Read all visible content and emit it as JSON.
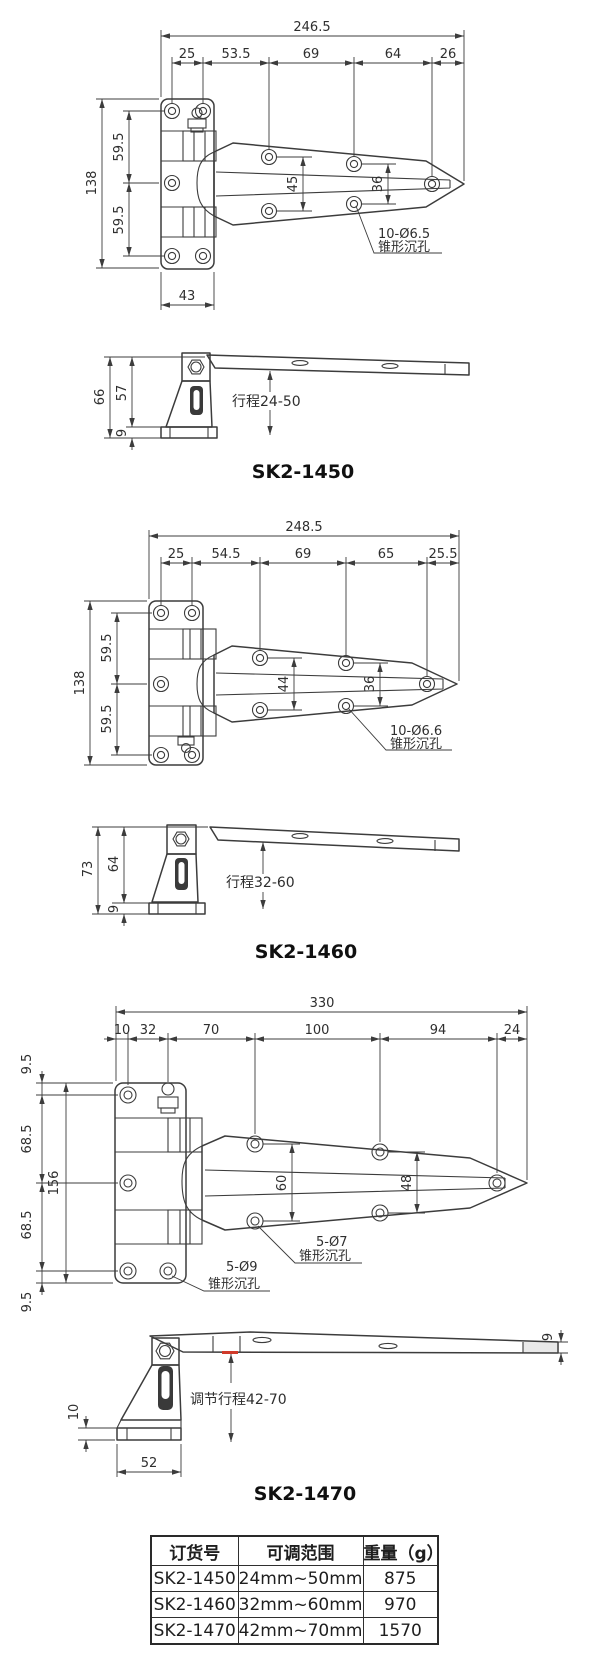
{
  "drawings": [
    {
      "title": "SK2-1450",
      "top": {
        "total": "246.5",
        "segs": [
          "25",
          "53.5",
          "69",
          "64",
          "26"
        ],
        "height": "138",
        "hseg1": "59.5",
        "hseg2": "59.5",
        "inner1": "45",
        "inner2": "36",
        "note1": "10-Ø6.5",
        "note2": "锥形沉孔",
        "base": "43"
      },
      "side": {
        "total": "66",
        "upper": "57",
        "base": "9",
        "stroke": "行程24-50"
      }
    },
    {
      "title": "SK2-1460",
      "top": {
        "total": "248.5",
        "segs": [
          "25",
          "54.5",
          "69",
          "65",
          "25.5"
        ],
        "height": "138",
        "hseg1": "59.5",
        "hseg2": "59.5",
        "inner1": "44",
        "inner2": "36",
        "note1": "10-Ø6.6",
        "note2": "锥形沉孔"
      },
      "side": {
        "total": "73",
        "upper": "64",
        "base": "9",
        "stroke": "行程32-60"
      }
    },
    {
      "title": "SK2-1470",
      "top": {
        "total": "330",
        "segs": [
          "10",
          "32",
          "70",
          "100",
          "94",
          "24"
        ],
        "height": "156",
        "hsegs": [
          "9.5",
          "68.5",
          "68.5",
          "9.5"
        ],
        "inner1": "60",
        "inner2": "48",
        "note_arm1": "5-Ø7",
        "note_arm2": "锥形沉孔",
        "note_plate1": "5-Ø9",
        "note_plate2": "锥形沉孔"
      },
      "side": {
        "thickness": "9",
        "base_h": "10",
        "base_w": "52",
        "stroke": "调节行程42-70"
      }
    }
  ],
  "table": {
    "headers": [
      "订货号",
      "可调范围",
      "重量（g）"
    ],
    "rows": [
      [
        "SK2-1450",
        "24mm~50mm",
        "875"
      ],
      [
        "SK2-1460",
        "32mm~60mm",
        "970"
      ],
      [
        "SK2-1470",
        "42mm~70mm",
        "1570"
      ]
    ]
  }
}
